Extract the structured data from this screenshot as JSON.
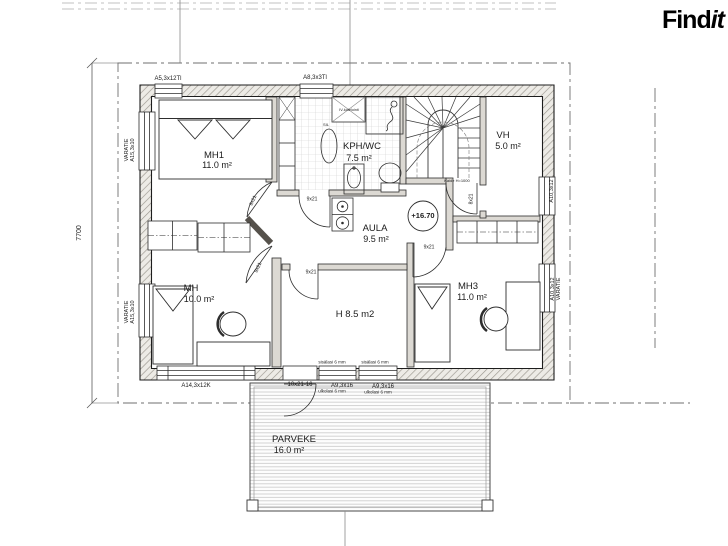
{
  "brand": {
    "find": "Find",
    "it": "it"
  },
  "rooms": {
    "mh1": {
      "name": "MH1",
      "area": "11.0 m²"
    },
    "kph": {
      "name": "KPH/WC",
      "area": "7.5 m²"
    },
    "vh": {
      "name": "VH",
      "area": "5.0 m²"
    },
    "aula": {
      "name": "AULA",
      "area": "9.5 m²"
    },
    "mh": {
      "name": "MH",
      "area": "10.0 m²"
    },
    "mh3": {
      "name": "MH3",
      "area": "11.0 m²"
    },
    "h": {
      "name": "H 8.5 m2"
    },
    "parveke": {
      "name": "PARVEKE",
      "area": "16.0 m²"
    }
  },
  "marks": {
    "level": "+16.70",
    "dim_left": "7700",
    "kaide": "Kaide H=1000",
    "iv": "IV-kotelointi",
    "sil": "SIL"
  },
  "openings": {
    "top_left": "A5,3x12Tl",
    "top_mid": "A8,3x3Tl",
    "left_varatie": "VARATIE",
    "left_size": "A15,3x10",
    "right_upper": "A10,3x12",
    "right_lower_size": "A10,3x12",
    "right_lower_varatie": "VARATIE",
    "bottom_window": "A14,3x12K",
    "balcony_door": "10x21-16",
    "bottom_win_a": "A9,3x16",
    "bottom_win_b": "A9,3x16",
    "inner_glass": "sisälasi 6 mm",
    "outer_glass": "ulkolasi 6 mm",
    "door_9": "9x21",
    "door_8": "8x21"
  }
}
